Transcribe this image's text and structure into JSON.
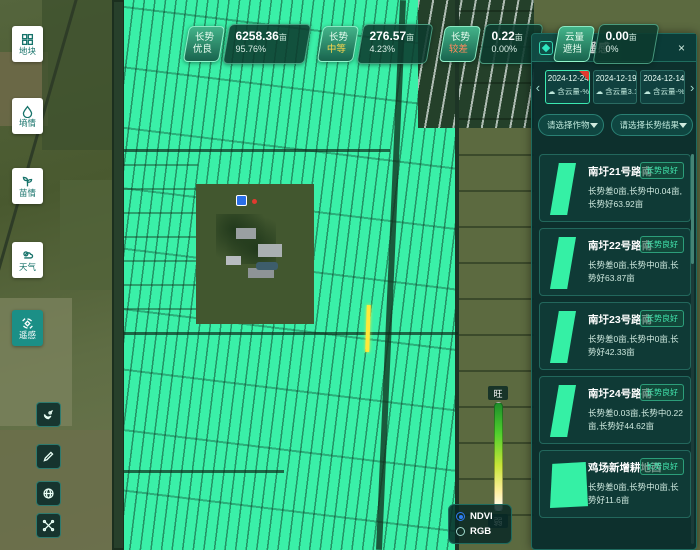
{
  "app": {
    "title": "卫星遥感"
  },
  "sidebar": {
    "items": [
      {
        "label": "地块",
        "icon": "layers-icon",
        "active": false
      },
      {
        "label": "墒情",
        "icon": "droplet-icon",
        "active": false
      },
      {
        "label": "苗情",
        "icon": "sprout-icon",
        "active": false
      },
      {
        "label": "天气",
        "icon": "weather-icon",
        "active": false
      },
      {
        "label": "遥感",
        "icon": "satellite-icon",
        "active": true
      }
    ],
    "tools": [
      {
        "icon": "satellite-dish-icon"
      },
      {
        "icon": "pencil-icon"
      },
      {
        "icon": "globe-icon"
      },
      {
        "icon": "measure-icon"
      }
    ]
  },
  "stats": {
    "cards": [
      {
        "tag_top": "长势",
        "tag_bottom": "优良",
        "area": "6258.36",
        "unit": "亩",
        "percent": "95.76%",
        "status_color": "#eafff2"
      },
      {
        "tag_top": "长势",
        "tag_bottom": "中等",
        "area": "276.57",
        "unit": "亩",
        "percent": "4.23%",
        "status_color": "#ffd84d"
      },
      {
        "tag_top": "长势",
        "tag_bottom": "较差",
        "area": "0.22",
        "unit": "亩",
        "percent": "0.00%",
        "status_color": "#ff8a5c"
      },
      {
        "tag_top": "云量",
        "tag_bottom": "遮挡",
        "area": "0.00",
        "unit": "亩",
        "percent": "0%",
        "status_color": "#eafff2"
      }
    ]
  },
  "panel": {
    "title": "卫星遥感",
    "close_icon": "×",
    "prev_icon": "‹",
    "next_icon": "›",
    "cloud_icon": "☁",
    "dates": [
      {
        "date": "2024-12-24",
        "cloud": "含云量-%",
        "new_badge": true,
        "selected": true
      },
      {
        "date": "2024-12-19",
        "cloud": "含云量3.13%",
        "new_badge": false,
        "selected": false
      },
      {
        "date": "2024-12-14",
        "cloud": "含云量-%",
        "new_badge": false,
        "selected": false
      }
    ],
    "filters": [
      {
        "placeholder": "请选择作物"
      },
      {
        "placeholder": "请选择长势结果"
      }
    ],
    "plots": [
      {
        "title": "南圩21号路南",
        "badge": "长势良好",
        "desc": "长势差0亩,长势中0.04亩,长势好63.92亩"
      },
      {
        "title": "南圩22号路南",
        "badge": "长势良好",
        "desc": "长势差0亩,长势中0亩,长势好63.87亩"
      },
      {
        "title": "南圩23号路南",
        "badge": "长势良好",
        "desc": "长势差0亩,长势中0亩,长势好42.33亩"
      },
      {
        "title": "南圩24号路南",
        "badge": "长势良好",
        "desc": "长势差0.03亩,长势中0.22亩,长势好44.62亩"
      },
      {
        "title": "鸡场新增耕地西",
        "badge": "长势良好",
        "desc": "长势差0亩,长势中0亩,长势好11.6亩"
      }
    ]
  },
  "legend": {
    "top": "旺",
    "bottom": "弱"
  },
  "layers": {
    "options": [
      {
        "label": "NDVI",
        "selected": true
      },
      {
        "label": "RGB",
        "selected": false
      }
    ]
  },
  "colors": {
    "ndvi_overlay": "#3af0a8",
    "panel_bg": "#0b2c2c",
    "accent_teal": "#2ee6c0",
    "good": "#43e8b0",
    "medium": "#ffd84d",
    "poor": "#ff8a5c",
    "marker_yellow": "#ffe93a"
  }
}
